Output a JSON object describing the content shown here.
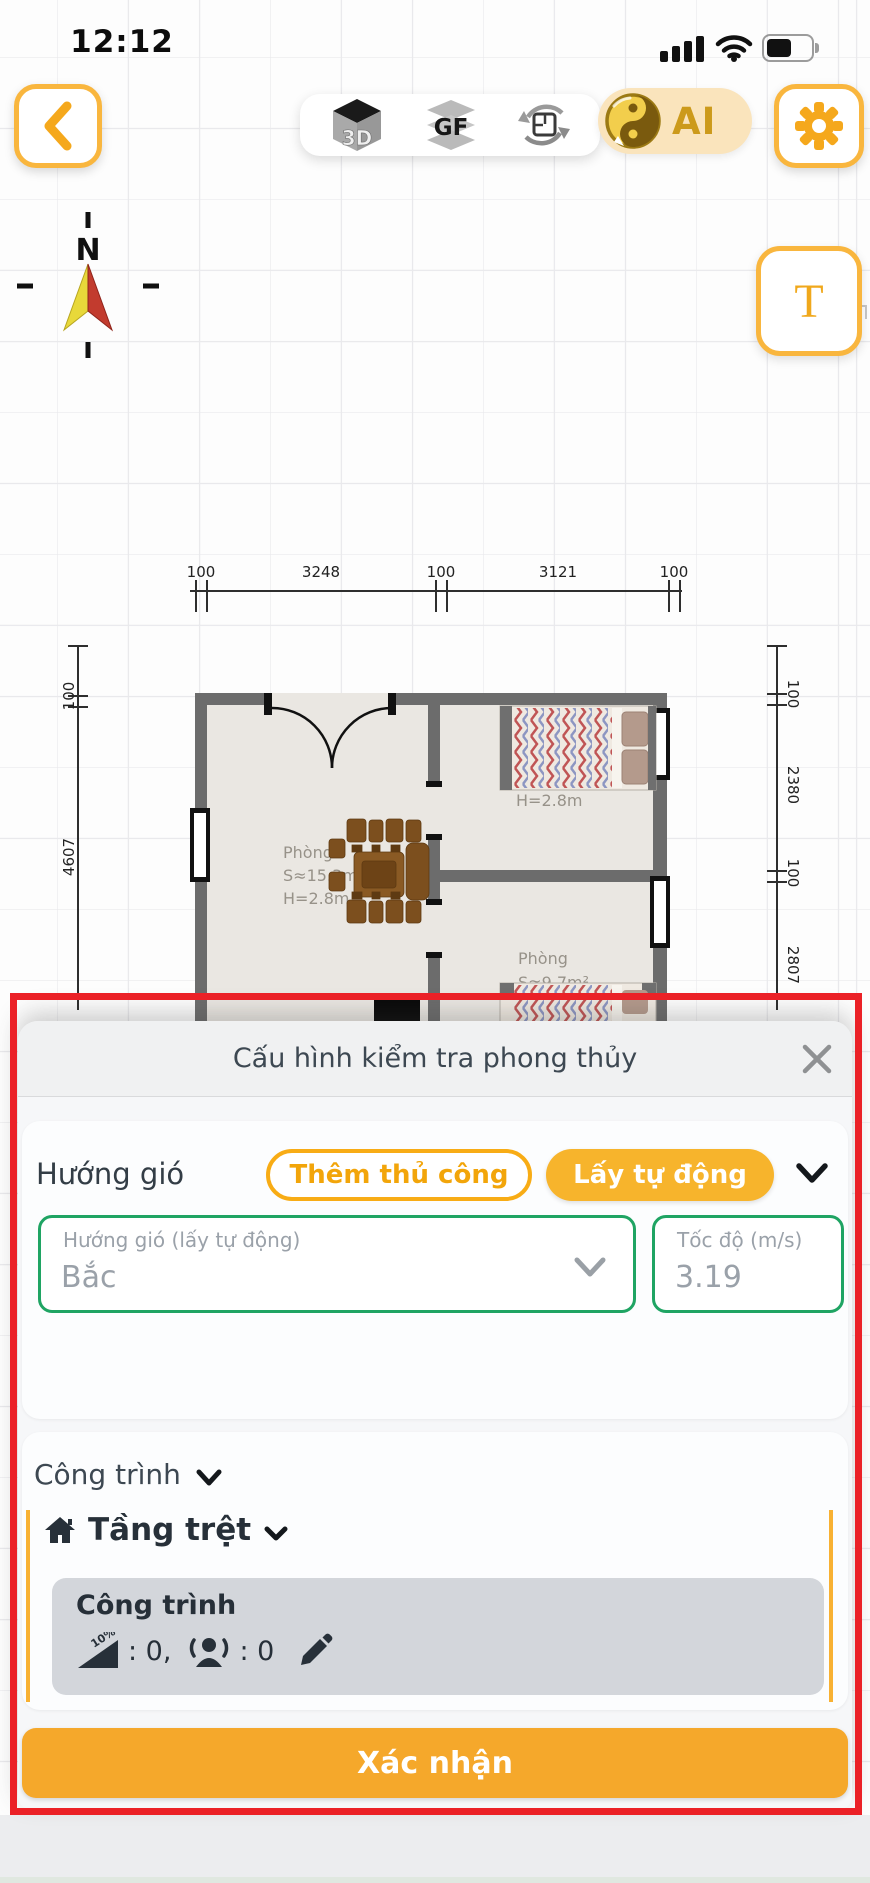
{
  "status_bar": {
    "time": "12:12"
  },
  "toolbar": {
    "view_3d": "3D",
    "view_gf": "GF",
    "ai_label": "AI",
    "text_tool": "T"
  },
  "compass": {
    "north": "N"
  },
  "floorplan": {
    "dims_top": [
      "100",
      "3248",
      "100",
      "3121",
      "100"
    ],
    "dims_left": [
      "100",
      "4607"
    ],
    "dims_right": [
      "100",
      "2380",
      "100",
      "2807"
    ],
    "living": {
      "name": "Phòng",
      "area": "S≈15.3m²",
      "height": "H=2.8m"
    },
    "bedroom1": {
      "height": "H=2.8m"
    },
    "bedroom2": {
      "name": "Phòng",
      "area": "S≈9.7m²"
    }
  },
  "sheet": {
    "title": "Cấu hình kiểm tra phong thủy",
    "wind": {
      "label": "Hướng gió",
      "manual_button": "Thêm thủ công",
      "auto_button": "Lấy tự động",
      "direction_field": {
        "label": "Hướng gió (lấy tự động)",
        "value": "Bắc"
      },
      "speed_field": {
        "label": "Tốc độ (m/s)",
        "value": "3.19"
      }
    },
    "building": {
      "section_label": "Công trình",
      "floor_label": "Tầng trệt",
      "item_title": "Công trình",
      "slope_icon_text": "10%",
      "slope_stat": ": 0,",
      "people_stat": ": 0"
    },
    "confirm_button": "Xác nhận"
  },
  "colors": {
    "accent_yellow": "#F7B42C",
    "confirm_yellow": "#F5A82B",
    "green_border": "#1FA463",
    "red_highlight": "#EB2127",
    "ai_pill_bg": "#FAE4BC"
  }
}
